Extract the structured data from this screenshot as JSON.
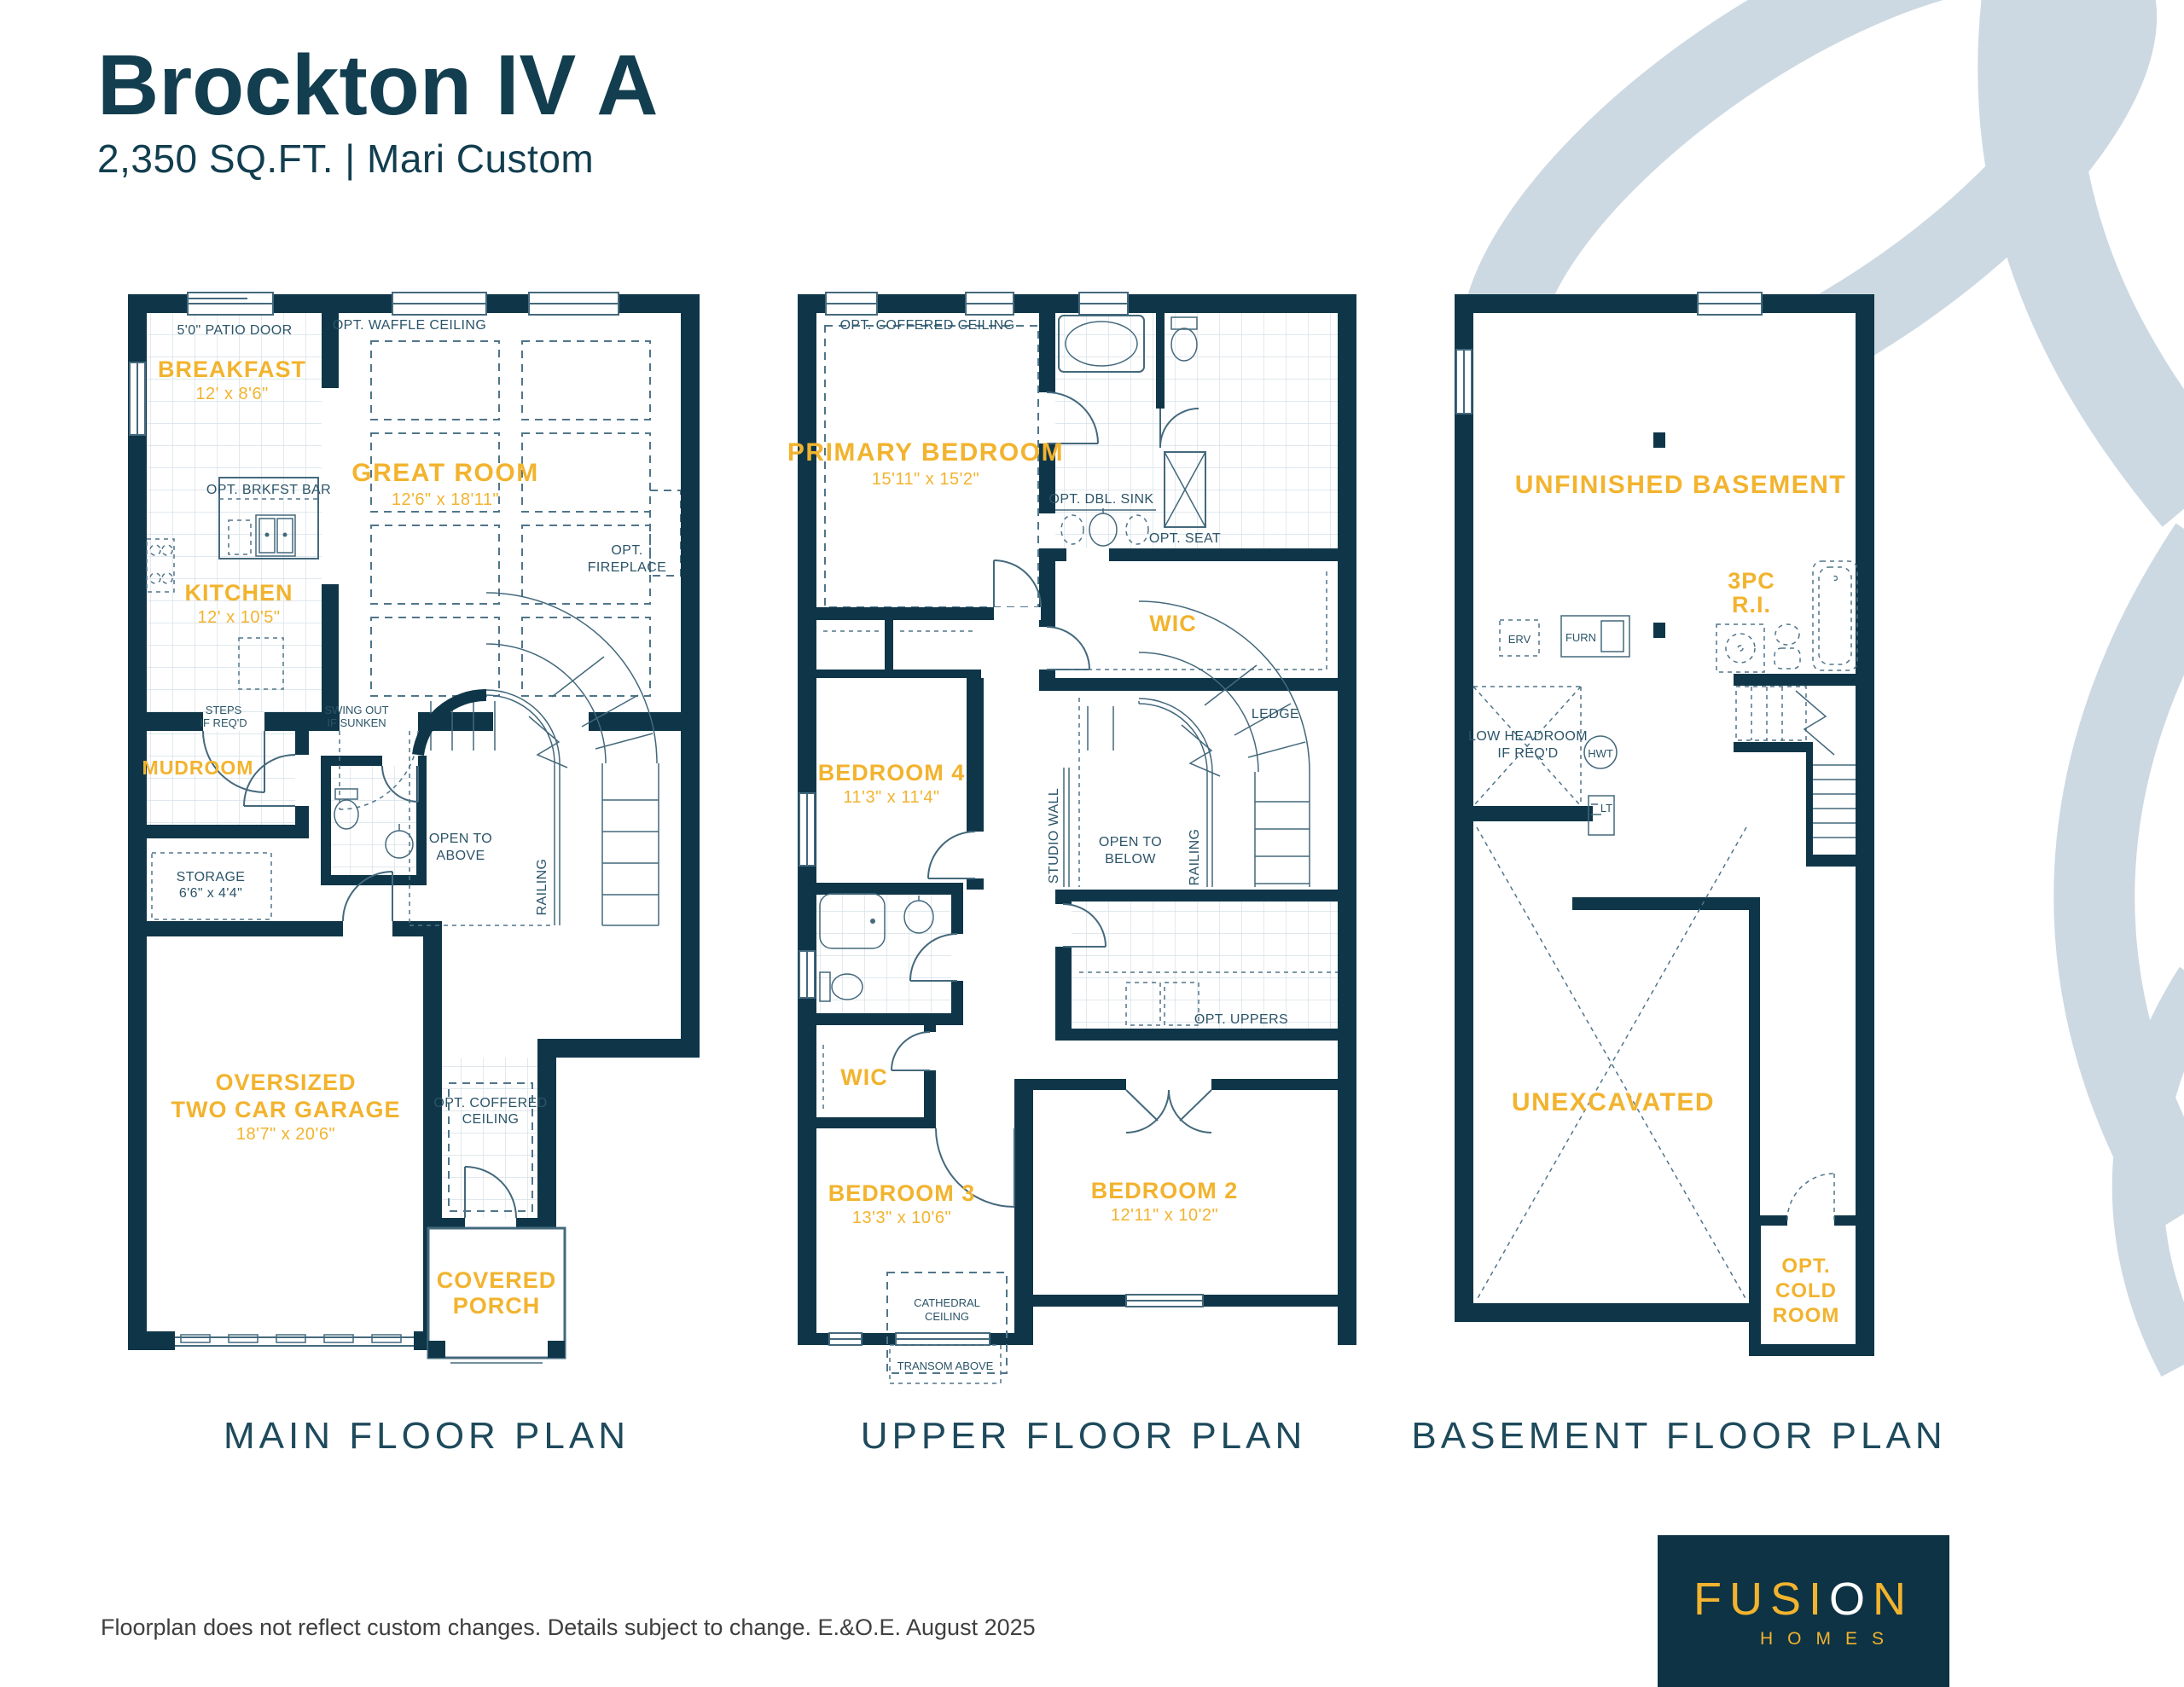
{
  "header": {
    "title": "Brockton IV A",
    "subtitle": "2,350 SQ.FT.  | Mari Custom"
  },
  "colors": {
    "wall_navy": "#0F3648",
    "accent_yellow": "#F2B32E",
    "title_teal": "#123E4F",
    "swoosh_blue": "#CCD9E2"
  },
  "plans": {
    "main": {
      "caption": "MAIN FLOOR PLAN",
      "labels": {
        "patio_door": "5'0\" PATIO DOOR",
        "breakfast": "BREAKFAST",
        "breakfast_dim": "12' x 8'6\"",
        "waffle": "OPT. WAFFLE CEILING",
        "great_room": "GREAT ROOM",
        "great_room_dim": "12'6\" x 18'11\"",
        "brkfst_bar": "OPT. BRKFST BAR",
        "kitchen": "KITCHEN",
        "kitchen_dim": "12' x 10'5\"",
        "fireplace_1": "OPT.",
        "fireplace_2": "FIREPLACE",
        "steps_1": "STEPS",
        "steps_2": "IF REQ'D",
        "swing_1": "SWING OUT",
        "swing_2": "IF SUNKEN",
        "mudroom": "MUDROOM",
        "storage": "STORAGE",
        "storage_dim": "6'6\" x 4'4\"",
        "open_above_1": "OPEN TO",
        "open_above_2": "ABOVE",
        "railing": "RAILING",
        "garage_1": "OVERSIZED",
        "garage_2": "TWO CAR GARAGE",
        "garage_dim": "18'7\" x 20'6\"",
        "coffered_1": "OPT. COFFERED",
        "coffered_2": "CEILING",
        "porch_1": "COVERED",
        "porch_2": "PORCH"
      }
    },
    "upper": {
      "caption": "UPPER FLOOR PLAN",
      "labels": {
        "coffered": "OPT. COFFERED CEILING",
        "primary": "PRIMARY BEDROOM",
        "primary_dim": "15'11\" x 15'2\"",
        "dbl_sink": "OPT. DBL. SINK",
        "opt_seat": "OPT. SEAT",
        "wic_primary": "WIC",
        "ledge": "LEDGE",
        "studio_wall": "STUDIO WALL",
        "open_below_1": "OPEN TO",
        "open_below_2": "BELOW",
        "railing": "RAILING",
        "bedroom4": "BEDROOM 4",
        "bedroom4_dim": "11'3\" x 11'4\"",
        "opt_uppers": "OPT. UPPERS",
        "wic2": "WIC",
        "bedroom3": "BEDROOM 3",
        "bedroom3_dim": "13'3\" x 10'6\"",
        "bedroom2": "BEDROOM 2",
        "bedroom2_dim": "12'11\" x 10'2\"",
        "cathedral_1": "CATHEDRAL",
        "cathedral_2": "CEILING",
        "transom": "TRANSOM ABOVE"
      }
    },
    "basement": {
      "caption": "BASEMENT FLOOR PLAN",
      "labels": {
        "unfinished": "UNFINISHED BASEMENT",
        "threepc_1": "3PC",
        "threepc_2": "R.I.",
        "erv": "ERV",
        "furn": "FURN",
        "low_1": "LOW HEADROOM",
        "low_2": "IF REQ'D",
        "hwt": "HWT",
        "lt": "LT",
        "unexcavated": "UNEXCAVATED",
        "cold_1": "OPT.",
        "cold_2": "COLD",
        "cold_3": "ROOM"
      }
    }
  },
  "footer": {
    "disclaimer": "Floorplan does not reflect custom changes. Details subject to change. E.&O.E. August 2025"
  },
  "logo": {
    "brand_1": "FUSI",
    "brand_o": "O",
    "brand_2": "N",
    "sub": "HOMES"
  }
}
